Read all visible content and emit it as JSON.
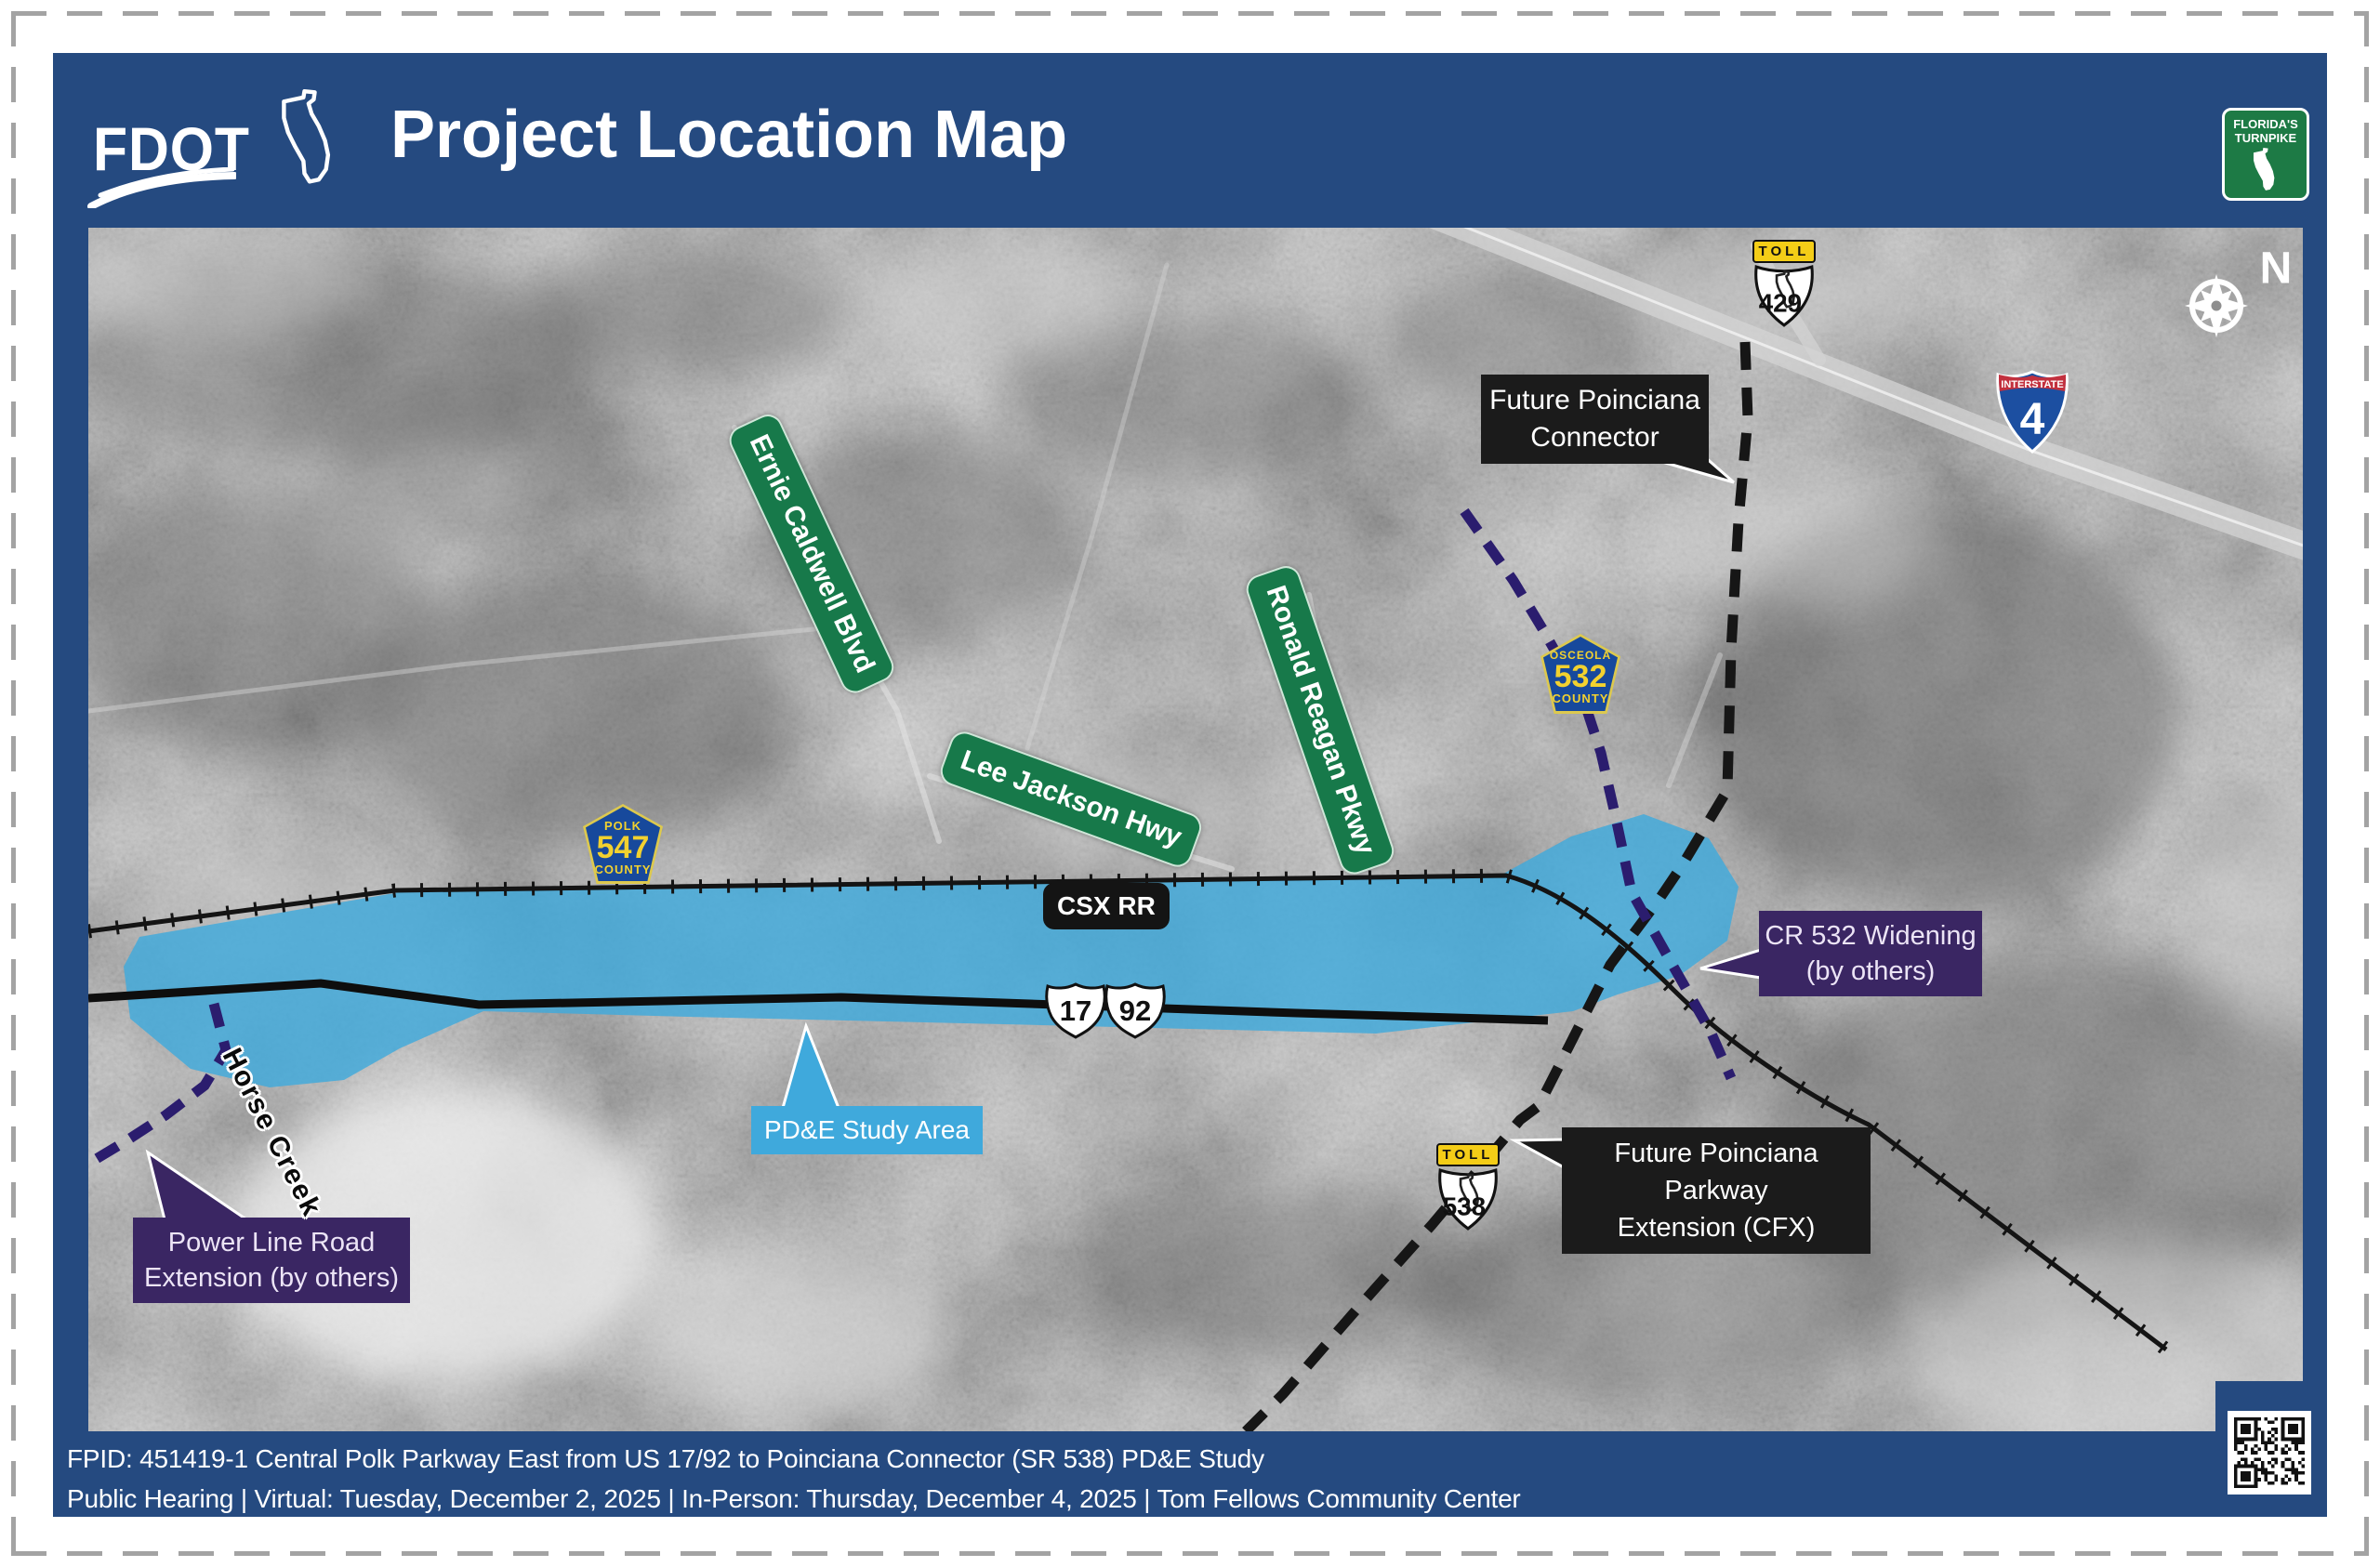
{
  "header": {
    "brand": "FDOT",
    "title": "Project Location Map",
    "turnpike": {
      "line1": "FLORIDA'S",
      "line2": "TURNPIKE"
    }
  },
  "map": {
    "compass_label": "N",
    "street_labels": {
      "ernie_caldwell": "Ernie Caldwell Blvd",
      "lee_jackson": "Lee Jackson Hwy",
      "ronald_reagan": "Ronald Reagan Pkwy"
    },
    "shields": {
      "toll_429": {
        "banner": "TOLL",
        "number": "429"
      },
      "toll_538": {
        "banner": "TOLL",
        "number": "538"
      },
      "interstate_4": {
        "banner": "INTERSTATE",
        "number": "4"
      },
      "county_532": {
        "county": "OSCEOLA",
        "number": "532",
        "suffix": "COUNTY"
      },
      "county_547": {
        "county": "POLK",
        "number": "547",
        "suffix": "COUNTY"
      },
      "us_17": "17",
      "us_92": "92"
    },
    "callouts": {
      "csx": "CSX RR",
      "study_area": "PD&E Study Area",
      "poinciana_connector": {
        "line1": "Future Poinciana",
        "line2": "Connector"
      },
      "cr532_widening": {
        "line1": "CR 532 Widening",
        "line2": "(by others)"
      },
      "parkway_extension": {
        "line1": "Future Poinciana Parkway",
        "line2": "Extension  (CFX)"
      },
      "power_line": {
        "line1": "Power Line Road",
        "line2": "Extension (by others)"
      },
      "horse_creek": "Horse Creek"
    }
  },
  "footer": {
    "line1": "FPID: 451419-1 Central Polk Parkway East from US 17/92 to Poinciana Connector (SR 538) PD&E Study",
    "line2": "Public Hearing | Virtual: Tuesday, December 2, 2025 | In-Person: Thursday, December 4, 2025 | Tom Fellows Community Center"
  },
  "colors": {
    "frame_blue": "#254a80",
    "study_area_blue": "#3fa9dc",
    "street_label_green": "#17794a",
    "callout_purple": "#3a2663",
    "callout_black": "#1b1b1b",
    "turnpike_green": "#1d7a45",
    "toll_yellow": "#f4cd17",
    "county_blue": "#17499c",
    "interstate_blue": "#1c4fa1",
    "interstate_red": "#c2303e"
  }
}
